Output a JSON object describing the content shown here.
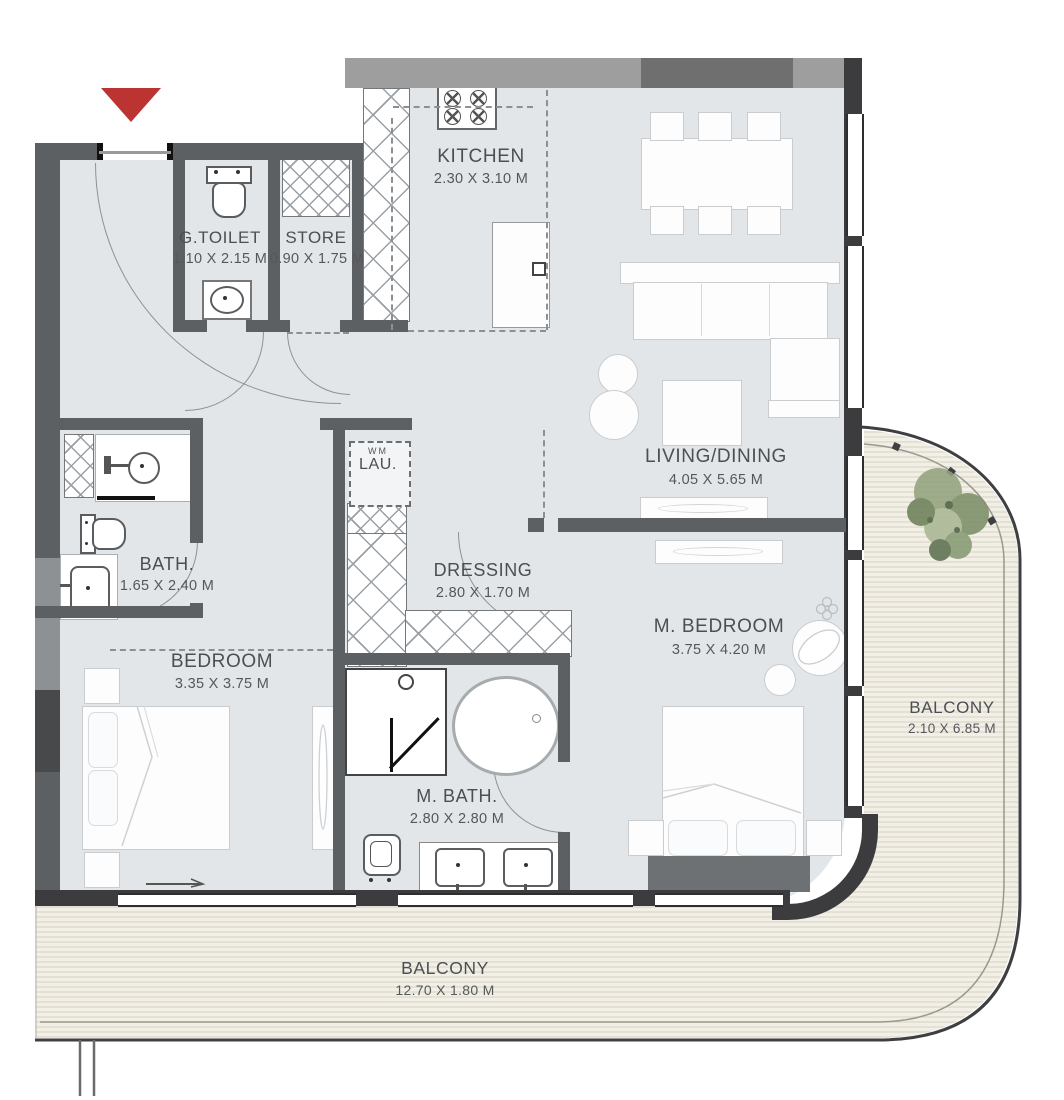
{
  "rooms": [
    {
      "id": "kitchen",
      "label": "KITCHEN",
      "dims": "2.30 X 3.10 M"
    },
    {
      "id": "g_toilet",
      "label": "G.TOILET",
      "dims": "1.10 X 2.15 M"
    },
    {
      "id": "store",
      "label": "STORE",
      "dims": "0.90 X 1.75 M"
    },
    {
      "id": "living_dining",
      "label": "LIVING/DINING",
      "dims": "4.05 X 5.65 M"
    },
    {
      "id": "bath",
      "label": "BATH.",
      "dims": "1.65 X 2.40 M"
    },
    {
      "id": "laundry",
      "label": "LAU.",
      "dims": ""
    },
    {
      "id": "dressing",
      "label": "DRESSING",
      "dims": "2.80 X 1.70 M"
    },
    {
      "id": "m_bedroom",
      "label": "M. BEDROOM",
      "dims": "3.75 X 4.20 M"
    },
    {
      "id": "bedroom",
      "label": "BEDROOM",
      "dims": "3.35 X 3.75 M"
    },
    {
      "id": "m_bath",
      "label": "M. BATH.",
      "dims": "2.80 X 2.80 M"
    },
    {
      "id": "balcony_side",
      "label": "BALCONY",
      "dims": "2.10 X 6.85 M"
    },
    {
      "id": "balcony_bottom",
      "label": "BALCONY",
      "dims": "12.70 X 1.80 M"
    }
  ],
  "laundry_tag": "WM",
  "colors": {
    "floor": "#e2e6e9",
    "wall": "#5d6063",
    "wall_dark": "#3c3c3e",
    "wall_light": "#9e9e9e",
    "balcony_deck": "#f1efe6",
    "deck_stripe": "#dbd7c9",
    "entrance_marker_red": "#bb3431",
    "plant_green": "#7c8f68",
    "label_text": "#4c4f52"
  }
}
